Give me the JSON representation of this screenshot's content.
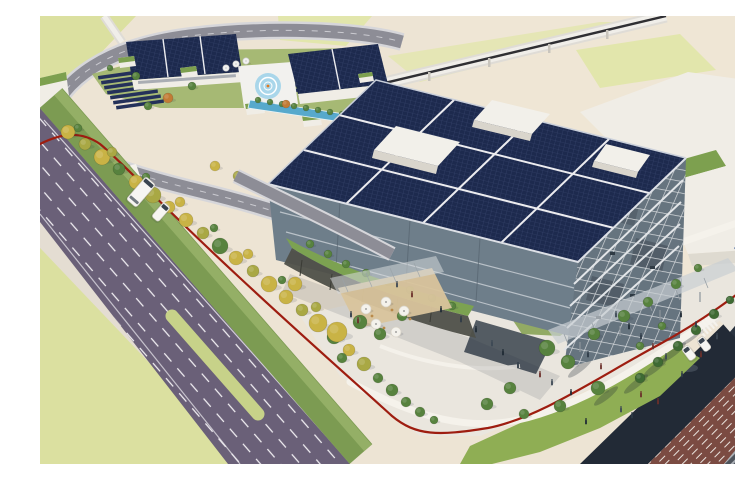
{
  "meta": {
    "title": "Aerial rendering of a corporate campus",
    "description": "Bird's-eye architectural rendering: a large office building with a dark-blue photovoltaic roof and exposed steel frame, a looping elevated test track with helipad buildings and ground solar arrays to the northwest, a tree-lined purple boulevard along the southwest, a landscaped pedestrian plaza with canopy walkway leading to a rail station at the east, and a dark red property boundary line around the site."
  },
  "palette": {
    "ground": "#EDE4D4",
    "groundWarm": "#F0E7D6",
    "field": "#DBE0A0",
    "fieldSoft": "#E2E6AC",
    "road": "#6A6078",
    "roadDash": "#F2F0F4",
    "sidewalk": "#E4DDD2",
    "median": "#C7D289",
    "verge": "#7C9B52",
    "vergeLight": "#9AB46B",
    "treeYellow": "#C9B345",
    "treeOlive": "#A9A844",
    "treeGreen": "#57823E",
    "treeDark": "#3E6A33",
    "treeOrange": "#C27B35",
    "redLine": "#9E1D10",
    "track": "#8D8D96",
    "trackEdge": "#D6D6DA",
    "trackDash": "#CBCBD1",
    "solar": "#1D2A4E",
    "solarGrid": "#3A4870",
    "solarRow": "#24315A",
    "seam": "#ECECEF",
    "buildingWhite": "#F0EDE6",
    "buildingShade": "#DEDAD0",
    "roofGreen": "#7DA04F",
    "glass": "#6E7E8A",
    "glassDark": "#39434E",
    "mullion": "#C7CDD2",
    "truss": "#D8DBDE",
    "podium": "#7CA251",
    "wallDark": "#4F5049",
    "water": "#57A9CC",
    "helipad": "#A9D6EA",
    "helipadRing": "#FFFFFF",
    "helipadDot": "#E07820",
    "plaza": "#EAE6DE",
    "path": "#F5F2EB",
    "lawn": "#8FAE54",
    "lawnDark": "#7C9B45",
    "darkRoad": "#222A36",
    "railBed": "#7B4B42",
    "tie": "#4E545C",
    "tieLight": "#A9AEB4",
    "rail": "#C8CCD0",
    "canopy": "#C9CED3",
    "canopyBlue": "#4A699F",
    "canopyBlueLight": "#8A9BB8",
    "umbrella": "#F4F2EC",
    "deck": "#D9C49C",
    "vehicle": "#F6F5F2",
    "glassTint": "#3A4450",
    "shadow": "rgba(35,42,58,0.22)",
    "shadowSoft": "rgba(35,42,58,0.12)"
  },
  "scene": {
    "elements": [
      "test-track-loop",
      "helipad",
      "satellite-dishes",
      "ground-solar-arrays",
      "water-canal",
      "solar-panel-roof",
      "steel-frame-building",
      "green-roof-podium",
      "elevated-ramp",
      "boulevard",
      "median-island",
      "bus",
      "roadside-trees",
      "red-boundary-line",
      "pedestrian-plaza",
      "terrace-umbrellas",
      "canopy-walkway",
      "rail-station",
      "railway-tracks"
    ],
    "trees": {
      "roadside": [
        [
          28,
          116,
          7,
          "y"
        ],
        [
          45,
          128,
          6,
          "o"
        ],
        [
          62,
          141,
          8,
          "y"
        ],
        [
          79,
          153,
          6,
          "g"
        ],
        [
          96,
          166,
          7,
          "y"
        ],
        [
          113,
          179,
          8,
          "o"
        ],
        [
          129,
          191,
          6,
          "y"
        ],
        [
          146,
          204,
          7,
          "y"
        ],
        [
          163,
          217,
          6,
          "o"
        ],
        [
          180,
          230,
          8,
          "g"
        ],
        [
          196,
          242,
          7,
          "y"
        ],
        [
          213,
          255,
          6,
          "o"
        ],
        [
          229,
          268,
          8,
          "y"
        ],
        [
          246,
          281,
          7,
          "y"
        ],
        [
          262,
          294,
          6,
          "o"
        ],
        [
          278,
          307,
          9,
          "y"
        ],
        [
          294,
          321,
          7,
          "g"
        ],
        [
          309,
          334,
          6,
          "y"
        ],
        [
          324,
          348,
          7,
          "o"
        ],
        [
          38,
          112,
          4,
          "g"
        ],
        [
          72,
          136,
          5,
          "o"
        ],
        [
          106,
          161,
          4,
          "g"
        ],
        [
          140,
          186,
          5,
          "y"
        ],
        [
          174,
          212,
          4,
          "g"
        ],
        [
          208,
          238,
          5,
          "y"
        ],
        [
          242,
          264,
          4,
          "g"
        ],
        [
          276,
          291,
          5,
          "o"
        ],
        [
          338,
          362,
          5,
          "g"
        ],
        [
          352,
          374,
          6,
          "g"
        ],
        [
          366,
          386,
          5,
          "g"
        ],
        [
          380,
          396,
          5,
          "g"
        ],
        [
          394,
          404,
          4,
          "g"
        ]
      ],
      "campus": [
        [
          218,
          84,
          3,
          "g"
        ],
        [
          230,
          86,
          3,
          "g"
        ],
        [
          242,
          88,
          3,
          "g"
        ],
        [
          254,
          90,
          3,
          "g"
        ],
        [
          266,
          92,
          3,
          "g"
        ],
        [
          278,
          94,
          3,
          "g"
        ],
        [
          290,
          96,
          3,
          "g"
        ],
        [
          302,
          98,
          3,
          "g"
        ],
        [
          314,
          100,
          3,
          "g"
        ],
        [
          96,
          60,
          4,
          "g"
        ],
        [
          152,
          70,
          4,
          "g"
        ],
        [
          108,
          90,
          4,
          "g"
        ],
        [
          70,
          52,
          3,
          "g"
        ],
        [
          128,
          82,
          5,
          "or"
        ],
        [
          246,
          88,
          4,
          "or"
        ],
        [
          252,
          158,
          6,
          "y"
        ],
        [
          285,
          164,
          6,
          "y"
        ],
        [
          175,
          150,
          5,
          "y"
        ],
        [
          198,
          160,
          5,
          "o"
        ]
      ],
      "podium": [
        [
          270,
          228,
          4,
          "g"
        ],
        [
          288,
          238,
          4,
          "g"
        ],
        [
          306,
          248,
          4,
          "g"
        ],
        [
          326,
          257,
          4,
          "g"
        ],
        [
          348,
          266,
          4,
          "g"
        ],
        [
          370,
          274,
          4,
          "g"
        ],
        [
          392,
          282,
          4,
          "g"
        ],
        [
          412,
          290,
          4,
          "g"
        ]
      ],
      "plaza": [
        [
          320,
          306,
          7,
          "g"
        ],
        [
          340,
          318,
          6,
          "g"
        ],
        [
          302,
          342,
          5,
          "g"
        ],
        [
          362,
          300,
          5,
          "g"
        ],
        [
          447,
          388,
          6,
          "g"
        ],
        [
          470,
          372,
          6,
          "g"
        ],
        [
          484,
          398,
          5,
          "g"
        ],
        [
          507,
          332,
          8,
          "g"
        ],
        [
          528,
          346,
          7,
          "g"
        ],
        [
          554,
          318,
          6,
          "g"
        ],
        [
          520,
          390,
          6,
          "g"
        ],
        [
          558,
          372,
          7,
          "g"
        ],
        [
          584,
          300,
          6,
          "g"
        ],
        [
          608,
          286,
          5,
          "g"
        ],
        [
          600,
          330,
          4,
          "g"
        ],
        [
          622,
          310,
          4,
          "g"
        ],
        [
          636,
          268,
          5,
          "g"
        ],
        [
          658,
          252,
          4,
          "g"
        ],
        [
          600,
          362,
          5,
          "d"
        ],
        [
          618,
          346,
          5,
          "d"
        ],
        [
          638,
          330,
          5,
          "d"
        ],
        [
          656,
          314,
          5,
          "d"
        ],
        [
          674,
          298,
          5,
          "d"
        ],
        [
          690,
          284,
          4,
          "d"
        ],
        [
          297,
          316,
          10,
          "y"
        ],
        [
          255,
          268,
          7,
          "y"
        ]
      ]
    },
    "tree_kinds": {
      "y": "treeYellow",
      "o": "treeOlive",
      "g": "treeGreen",
      "d": "treeDark",
      "or": "treeOrange"
    },
    "people": [
      [
        311,
        301
      ],
      [
        318,
        307
      ],
      [
        452,
        330
      ],
      [
        463,
        339
      ],
      [
        478,
        352
      ],
      [
        500,
        361
      ],
      [
        512,
        369
      ],
      [
        531,
        379
      ],
      [
        548,
        341
      ],
      [
        561,
        353
      ],
      [
        576,
        301
      ],
      [
        589,
        313
      ],
      [
        601,
        323
      ],
      [
        613,
        333
      ],
      [
        626,
        343
      ],
      [
        641,
        301
      ],
      [
        656,
        311
      ],
      [
        601,
        381
      ],
      [
        581,
        396
      ],
      [
        546,
        408
      ],
      [
        642,
        361
      ],
      [
        661,
        341
      ],
      [
        677,
        323
      ],
      [
        401,
        296
      ],
      [
        421,
        306
      ],
      [
        372,
        281
      ],
      [
        357,
        271
      ],
      [
        436,
        316
      ],
      [
        592,
        402
      ],
      [
        618,
        388
      ]
    ],
    "people_colors": [
      "#2E3A46",
      "#6B2F2A",
      "#3C4854",
      "#1F2A34"
    ],
    "vehicles": [
      {
        "type": "bus",
        "x": 101,
        "y": 176,
        "angle": 41
      },
      {
        "type": "van",
        "x": 121,
        "y": 196,
        "angle": 41
      },
      {
        "type": "car",
        "x": 649,
        "y": 337,
        "angle": -37
      },
      {
        "type": "car",
        "x": 664,
        "y": 328,
        "angle": -37
      }
    ],
    "umbrellas": [
      [
        326,
        293
      ],
      [
        346,
        286
      ],
      [
        364,
        295
      ],
      [
        336,
        308
      ],
      [
        356,
        316
      ]
    ],
    "dishes": [
      [
        186,
        52
      ],
      [
        196,
        48
      ],
      [
        206,
        45
      ]
    ],
    "lawn_shadows": [
      [
        596,
        368
      ],
      [
        615,
        352
      ],
      [
        634,
        336
      ],
      [
        652,
        320
      ],
      [
        566,
        380
      ],
      [
        540,
        352
      ]
    ],
    "helipad": {
      "cx": 228,
      "cy": 70,
      "marker": "helipad-circle"
    }
  }
}
